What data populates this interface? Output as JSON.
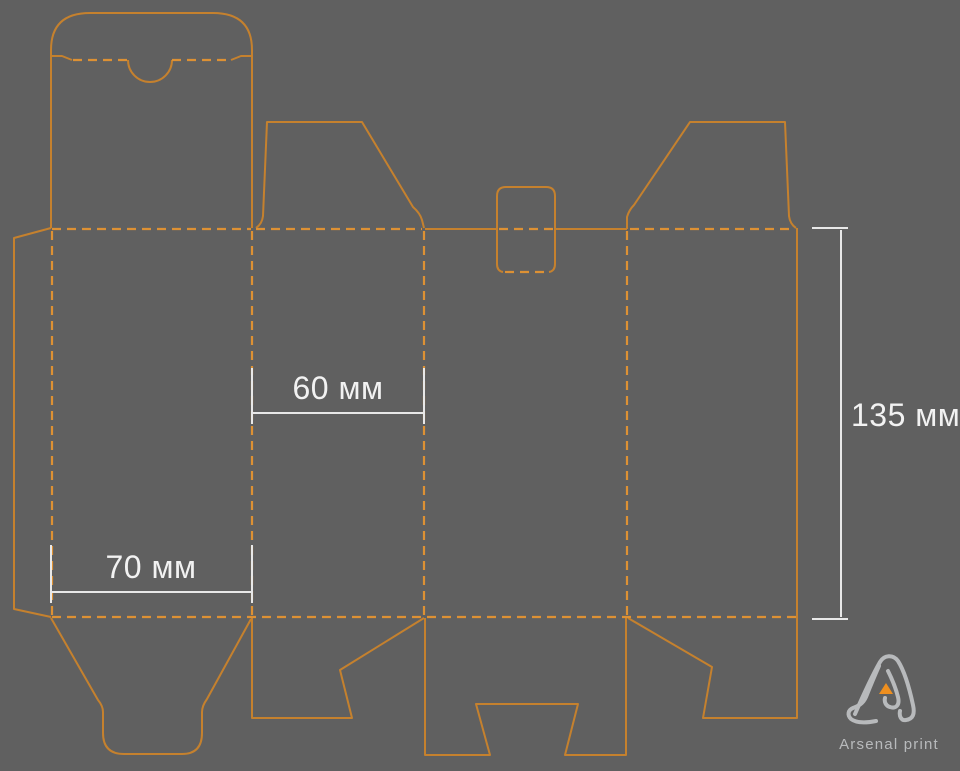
{
  "canvas": {
    "width": 960,
    "height": 771,
    "background": "#606060"
  },
  "colors": {
    "cut": "#c5812e",
    "fold": "#dd9134",
    "dim_line": "#e8e8e8",
    "dim_text": "#f2f2f2",
    "logo": "#b8babc",
    "accent": "#ee8f1f"
  },
  "diagram": {
    "type": "packaging-dieline",
    "line_legend": {
      "solid": "cut line",
      "dashed": "fold (crease) line"
    }
  },
  "dimensions": {
    "panel_width_small": {
      "value": 60,
      "unit": "мм",
      "label": "60 мм"
    },
    "panel_width_large": {
      "value": 70,
      "unit": "мм",
      "label": "70 мм"
    },
    "panel_height": {
      "value": 135,
      "unit": "мм",
      "label": "135 мм"
    }
  },
  "logo": {
    "text": "Arsenal print"
  }
}
